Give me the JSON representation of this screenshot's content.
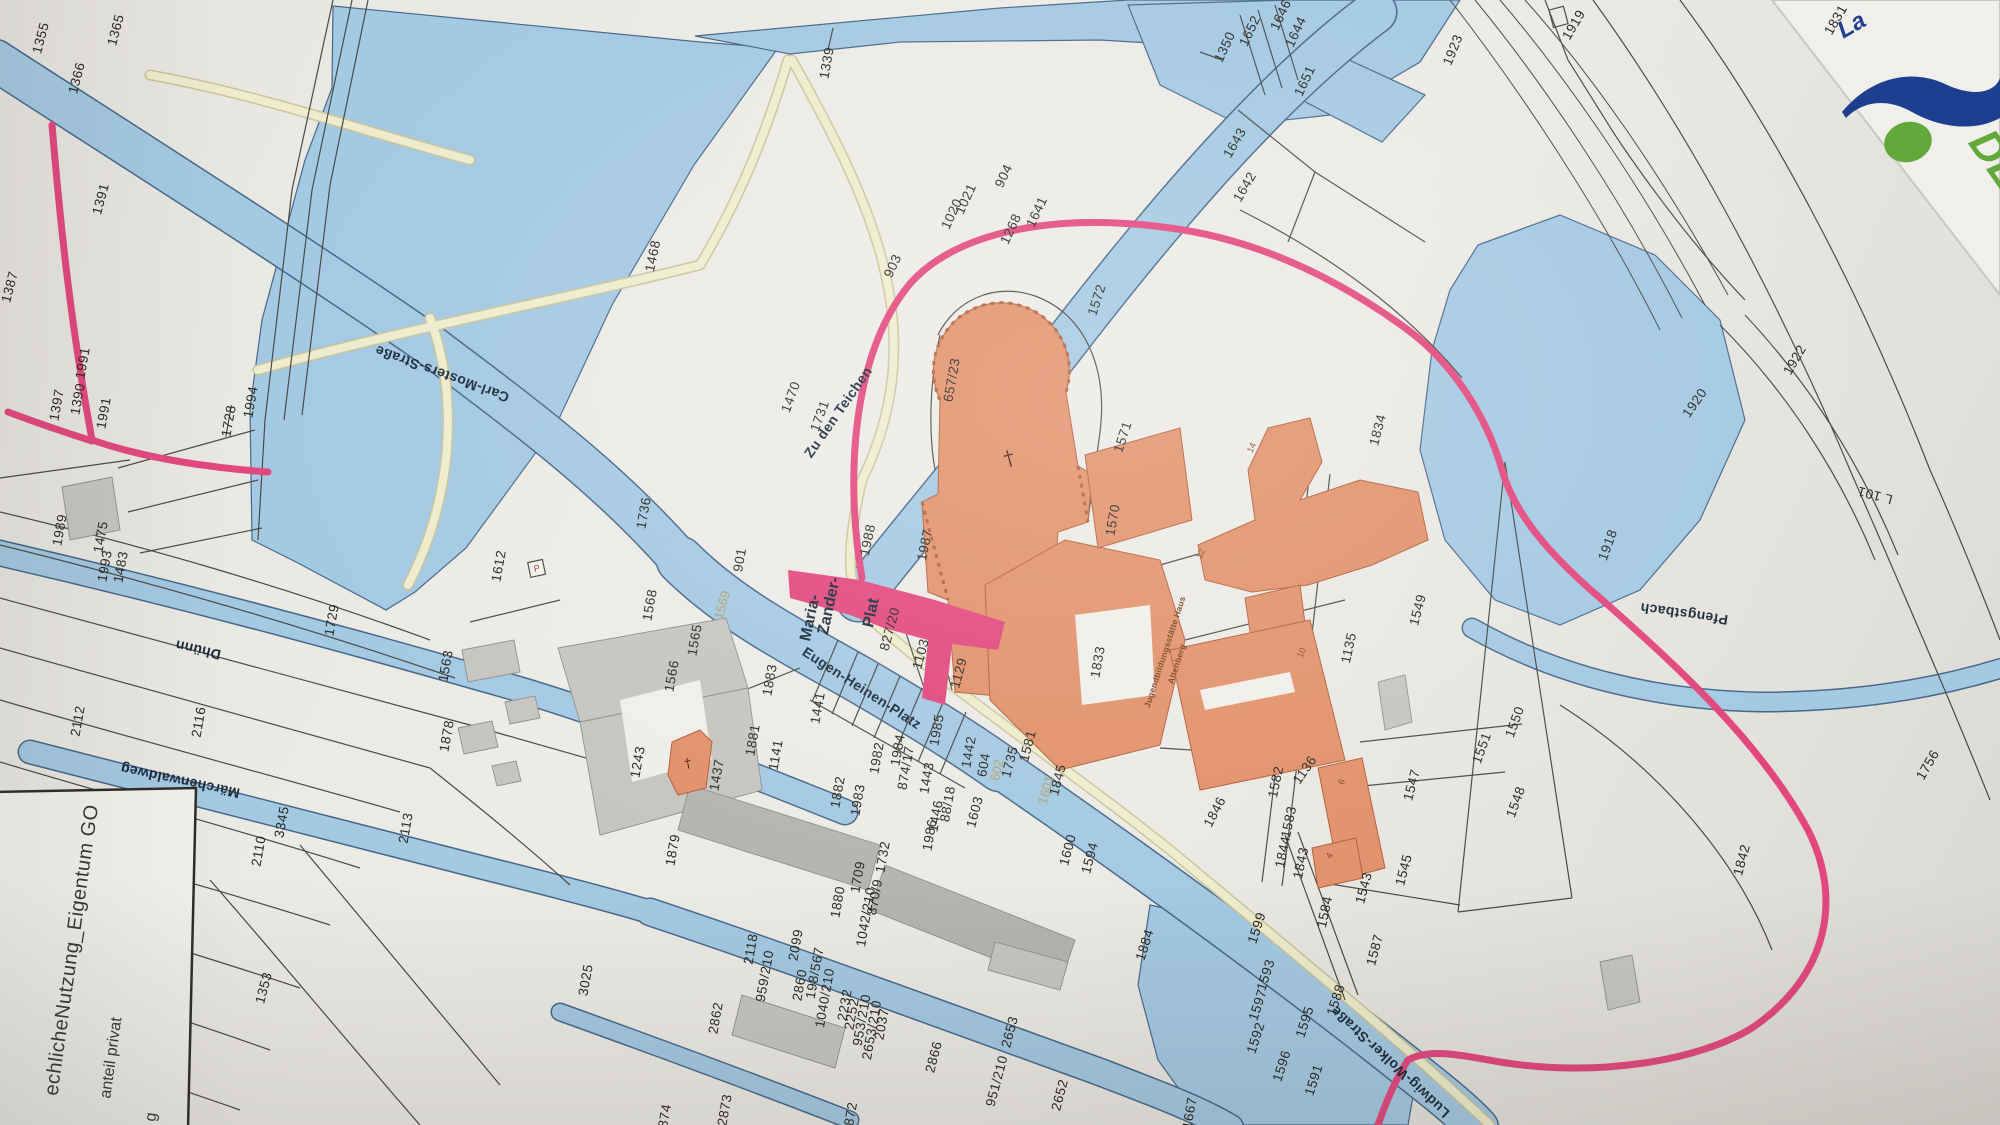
{
  "map": {
    "kind": "cadastral parcel map photo (Altenberg / Odenthal area)",
    "colors": {
      "paper": "#e9e7e1",
      "water": "#a4c9e3",
      "water_edge": "#47688a",
      "building_orange": "#e2916a",
      "building_gray": "#c6c5c1",
      "path_cream": "#eeeccd",
      "route_pink": "#e2487e",
      "boundary_line": "#4c4a45",
      "label_text": "#2b2923",
      "logo_navy": "#1e3f8f",
      "logo_green": "#61a93a"
    },
    "legend": {
      "line1": "echlicheNutzung_Eigentum GO",
      "line2": "anteil privat",
      "line3": "g"
    },
    "logo": {
      "italic_text": "La",
      "green_text": "DE"
    },
    "symbols": {
      "church_cross": "†",
      "parking": "P"
    },
    "labels": [
      {
        "t": "1355",
        "x": 41,
        "y": 38,
        "r": -75,
        "cls": "p"
      },
      {
        "t": "1366",
        "x": 77,
        "y": 78,
        "r": -75,
        "cls": "p"
      },
      {
        "t": "1365",
        "x": 116,
        "y": 30,
        "r": -75,
        "cls": "p"
      },
      {
        "t": "1391",
        "x": 101,
        "y": 199,
        "r": -75,
        "cls": "p"
      },
      {
        "t": "1387",
        "x": 10,
        "y": 287,
        "r": -75,
        "cls": "p"
      },
      {
        "t": "1397",
        "x": 57,
        "y": 405,
        "r": -80,
        "cls": "p"
      },
      {
        "t": "1390",
        "x": 78,
        "y": 399,
        "r": -80,
        "cls": "p"
      },
      {
        "t": "1991",
        "x": 83,
        "y": 363,
        "r": -80,
        "cls": "p"
      },
      {
        "t": "1991",
        "x": 104,
        "y": 413,
        "r": -80,
        "cls": "p"
      },
      {
        "t": "1994",
        "x": 251,
        "y": 402,
        "r": -80,
        "cls": "p"
      },
      {
        "t": "1728",
        "x": 229,
        "y": 421,
        "r": -80,
        "cls": "p strike"
      },
      {
        "t": "1989",
        "x": 60,
        "y": 530,
        "r": -80,
        "cls": "p"
      },
      {
        "t": "1475",
        "x": 101,
        "y": 537,
        "r": -80,
        "cls": "p"
      },
      {
        "t": "1993",
        "x": 105,
        "y": 566,
        "r": -80,
        "cls": "p"
      },
      {
        "t": "1483",
        "x": 121,
        "y": 567,
        "r": -80,
        "cls": "p"
      },
      {
        "t": "1729",
        "x": 332,
        "y": 620,
        "r": -80,
        "cls": "p"
      },
      {
        "t": "2112",
        "x": 78,
        "y": 721,
        "r": -80,
        "cls": "p"
      },
      {
        "t": "2116",
        "x": 199,
        "y": 722,
        "r": -80,
        "cls": "p"
      },
      {
        "t": "3345",
        "x": 282,
        "y": 822,
        "r": -80,
        "cls": "p"
      },
      {
        "t": "2110",
        "x": 259,
        "y": 851,
        "r": -80,
        "cls": "p"
      },
      {
        "t": "2113",
        "x": 406,
        "y": 828,
        "r": -80,
        "cls": "p"
      },
      {
        "t": "1353",
        "x": 264,
        "y": 988,
        "r": -75,
        "cls": "p"
      },
      {
        "t": "1468",
        "x": 653,
        "y": 256,
        "r": -78,
        "cls": "p"
      },
      {
        "t": "1339",
        "x": 827,
        "y": 63,
        "r": -80,
        "cls": "p"
      },
      {
        "t": "1470",
        "x": 791,
        "y": 397,
        "r": -70,
        "cls": "p"
      },
      {
        "t": "1731",
        "x": 820,
        "y": 416,
        "r": -70,
        "cls": "p"
      },
      {
        "t": "1736",
        "x": 644,
        "y": 513,
        "r": -80,
        "cls": "p"
      },
      {
        "t": "1612",
        "x": 499,
        "y": 566,
        "r": -80,
        "cls": "p"
      },
      {
        "t": "1563",
        "x": 446,
        "y": 666,
        "r": -80,
        "cls": "p"
      },
      {
        "t": "1878",
        "x": 447,
        "y": 736,
        "r": -80,
        "cls": "p"
      },
      {
        "t": "1568",
        "x": 650,
        "y": 605,
        "r": -80,
        "cls": "p"
      },
      {
        "t": "1565",
        "x": 695,
        "y": 640,
        "r": -80,
        "cls": "p"
      },
      {
        "t": "1566",
        "x": 672,
        "y": 676,
        "r": -80,
        "cls": "p"
      },
      {
        "t": "1243",
        "x": 638,
        "y": 762,
        "r": -80,
        "cls": "p"
      },
      {
        "t": "1437",
        "x": 717,
        "y": 775,
        "r": -80,
        "cls": "p"
      },
      {
        "t": "1881",
        "x": 753,
        "y": 740,
        "r": -80,
        "cls": "p"
      },
      {
        "t": "1141",
        "x": 776,
        "y": 755,
        "r": -80,
        "cls": "p"
      },
      {
        "t": "1883",
        "x": 770,
        "y": 680,
        "r": -80,
        "cls": "p"
      },
      {
        "t": "1441",
        "x": 818,
        "y": 708,
        "r": -80,
        "cls": "p"
      },
      {
        "t": "1879",
        "x": 673,
        "y": 850,
        "r": -80,
        "cls": "p"
      },
      {
        "t": "1882",
        "x": 838,
        "y": 792,
        "r": -80,
        "cls": "p"
      },
      {
        "t": "1983",
        "x": 858,
        "y": 800,
        "r": -80,
        "cls": "p"
      },
      {
        "t": "1982",
        "x": 877,
        "y": 758,
        "r": -80,
        "cls": "p"
      },
      {
        "t": "1984",
        "x": 898,
        "y": 750,
        "r": -80,
        "cls": "p"
      },
      {
        "t": "874/17",
        "x": 906,
        "y": 768,
        "r": -80,
        "cls": "p"
      },
      {
        "t": "1443",
        "x": 927,
        "y": 778,
        "r": -80,
        "cls": "p"
      },
      {
        "t": "1985",
        "x": 937,
        "y": 730,
        "r": -80,
        "cls": "p"
      },
      {
        "t": "1442",
        "x": 969,
        "y": 752,
        "r": -80,
        "cls": "p"
      },
      {
        "t": "604",
        "x": 984,
        "y": 765,
        "r": -80,
        "cls": "p"
      },
      {
        "t": "602",
        "x": 997,
        "y": 770,
        "r": -78,
        "cls": "tan"
      },
      {
        "t": "1601",
        "x": 1046,
        "y": 790,
        "r": -75,
        "cls": "tan"
      },
      {
        "t": "1569",
        "x": 722,
        "y": 605,
        "r": -75,
        "cls": "tan"
      },
      {
        "t": "901",
        "x": 740,
        "y": 560,
        "r": -80,
        "cls": "p"
      },
      {
        "t": "1988",
        "x": 868,
        "y": 540,
        "r": -78,
        "cls": "p"
      },
      {
        "t": "1987",
        "x": 925,
        "y": 545,
        "r": -78,
        "cls": "p"
      },
      {
        "t": "657/23",
        "x": 952,
        "y": 380,
        "r": -80,
        "cls": "p"
      },
      {
        "t": "1572",
        "x": 1097,
        "y": 300,
        "r": -72,
        "cls": "p"
      },
      {
        "t": "1571",
        "x": 1123,
        "y": 437,
        "r": -72,
        "cls": "p"
      },
      {
        "t": "1570",
        "x": 1113,
        "y": 520,
        "r": -80,
        "cls": "p"
      },
      {
        "t": "1833",
        "x": 1098,
        "y": 662,
        "r": -80,
        "cls": "p"
      },
      {
        "t": "1834",
        "x": 1378,
        "y": 430,
        "r": -75,
        "cls": "p"
      },
      {
        "t": "1103",
        "x": 921,
        "y": 654,
        "r": -75,
        "cls": "p"
      },
      {
        "t": "1129",
        "x": 959,
        "y": 673,
        "r": -75,
        "cls": "p"
      },
      {
        "t": "827/20",
        "x": 890,
        "y": 629,
        "r": -75,
        "cls": "p"
      },
      {
        "t": "1135",
        "x": 1349,
        "y": 648,
        "r": -78,
        "cls": "p"
      },
      {
        "t": "1549",
        "x": 1418,
        "y": 610,
        "r": -75,
        "cls": "p"
      },
      {
        "t": "1550",
        "x": 1515,
        "y": 722,
        "r": -70,
        "cls": "p"
      },
      {
        "t": "1551",
        "x": 1482,
        "y": 748,
        "r": -70,
        "cls": "p"
      },
      {
        "t": "1547",
        "x": 1412,
        "y": 785,
        "r": -75,
        "cls": "p"
      },
      {
        "t": "1548",
        "x": 1516,
        "y": 802,
        "r": -70,
        "cls": "p"
      },
      {
        "t": "1545",
        "x": 1404,
        "y": 870,
        "r": -75,
        "cls": "p"
      },
      {
        "t": "1543",
        "x": 1364,
        "y": 888,
        "r": -75,
        "cls": "p"
      },
      {
        "t": "1582",
        "x": 1276,
        "y": 782,
        "r": -78,
        "cls": "p"
      },
      {
        "t": "1583",
        "x": 1289,
        "y": 822,
        "r": -78,
        "cls": "p"
      },
      {
        "t": "1844",
        "x": 1283,
        "y": 852,
        "r": -78,
        "cls": "p"
      },
      {
        "t": "1843",
        "x": 1301,
        "y": 863,
        "r": -78,
        "cls": "p"
      },
      {
        "t": "1584",
        "x": 1325,
        "y": 912,
        "r": -78,
        "cls": "p"
      },
      {
        "t": "1587",
        "x": 1375,
        "y": 950,
        "r": -75,
        "cls": "p"
      },
      {
        "t": "1581",
        "x": 1028,
        "y": 746,
        "r": -75,
        "cls": "p"
      },
      {
        "t": "1735",
        "x": 1010,
        "y": 762,
        "r": -75,
        "cls": "p"
      },
      {
        "t": "1845",
        "x": 1058,
        "y": 780,
        "r": -75,
        "cls": "p"
      },
      {
        "t": "1846",
        "x": 1215,
        "y": 812,
        "r": -62,
        "cls": "p"
      },
      {
        "t": "1600",
        "x": 1068,
        "y": 850,
        "r": -75,
        "cls": "p"
      },
      {
        "t": "1594",
        "x": 1090,
        "y": 858,
        "r": -75,
        "cls": "p"
      },
      {
        "t": "1603",
        "x": 975,
        "y": 812,
        "r": -75,
        "cls": "p"
      },
      {
        "t": "1884",
        "x": 1145,
        "y": 945,
        "r": -72,
        "cls": "p"
      },
      {
        "t": "1599",
        "x": 1257,
        "y": 928,
        "r": -72,
        "cls": "p"
      },
      {
        "t": "1593",
        "x": 1266,
        "y": 975,
        "r": -72,
        "cls": "p"
      },
      {
        "t": "1597",
        "x": 1258,
        "y": 1005,
        "r": -72,
        "cls": "p"
      },
      {
        "t": "1592",
        "x": 1256,
        "y": 1038,
        "r": -72,
        "cls": "p"
      },
      {
        "t": "1596",
        "x": 1282,
        "y": 1066,
        "r": -72,
        "cls": "p"
      },
      {
        "t": "1591",
        "x": 1314,
        "y": 1080,
        "r": -72,
        "cls": "p"
      },
      {
        "t": "1595",
        "x": 1305,
        "y": 1022,
        "r": -72,
        "cls": "p"
      },
      {
        "t": "1588",
        "x": 1336,
        "y": 1000,
        "r": -72,
        "cls": "p"
      },
      {
        "t": "1842",
        "x": 1742,
        "y": 860,
        "r": -75,
        "cls": "p"
      },
      {
        "t": "1756",
        "x": 1928,
        "y": 765,
        "r": -60,
        "cls": "p"
      },
      {
        "t": "1920",
        "x": 1695,
        "y": 403,
        "r": -55,
        "cls": "p"
      },
      {
        "t": "1922",
        "x": 1795,
        "y": 360,
        "r": -60,
        "cls": "p"
      },
      {
        "t": "1918",
        "x": 1608,
        "y": 545,
        "r": -70,
        "cls": "p"
      },
      {
        "t": "1923",
        "x": 1453,
        "y": 50,
        "r": -68,
        "cls": "p"
      },
      {
        "t": "1919",
        "x": 1574,
        "y": 25,
        "r": -60,
        "cls": "p"
      },
      {
        "t": "1831",
        "x": 1836,
        "y": 20,
        "r": -60,
        "cls": "p"
      },
      {
        "t": "1350",
        "x": 1225,
        "y": 47,
        "r": -65,
        "cls": "p"
      },
      {
        "t": "1652",
        "x": 1250,
        "y": 31,
        "r": -65,
        "cls": "p"
      },
      {
        "t": "1646",
        "x": 1281,
        "y": 15,
        "r": -65,
        "cls": "p"
      },
      {
        "t": "1644",
        "x": 1296,
        "y": 32,
        "r": -65,
        "cls": "p"
      },
      {
        "t": "1651",
        "x": 1305,
        "y": 81,
        "r": -65,
        "cls": "p"
      },
      {
        "t": "1643",
        "x": 1235,
        "y": 143,
        "r": -60,
        "cls": "p"
      },
      {
        "t": "1642",
        "x": 1245,
        "y": 187,
        "r": -60,
        "cls": "p"
      },
      {
        "t": "904",
        "x": 1004,
        "y": 176,
        "r": -65,
        "cls": "p"
      },
      {
        "t": "1020",
        "x": 952,
        "y": 214,
        "r": -65,
        "cls": "p"
      },
      {
        "t": "1021",
        "x": 966,
        "y": 199,
        "r": -65,
        "cls": "p"
      },
      {
        "t": "1268",
        "x": 1011,
        "y": 229,
        "r": -65,
        "cls": "p"
      },
      {
        "t": "1641",
        "x": 1037,
        "y": 212,
        "r": -65,
        "cls": "p"
      },
      {
        "t": "903",
        "x": 893,
        "y": 266,
        "r": -65,
        "cls": "p"
      },
      {
        "t": "1880",
        "x": 838,
        "y": 902,
        "r": -80,
        "cls": "p"
      },
      {
        "t": "1709",
        "x": 858,
        "y": 877,
        "r": -80,
        "cls": "p"
      },
      {
        "t": "870/9",
        "x": 875,
        "y": 897,
        "r": -80,
        "cls": "p"
      },
      {
        "t": "1042/210",
        "x": 866,
        "y": 917,
        "r": -80,
        "cls": "p"
      },
      {
        "t": "1732",
        "x": 883,
        "y": 857,
        "r": -80,
        "cls": "p"
      },
      {
        "t": "1986",
        "x": 930,
        "y": 835,
        "r": -80,
        "cls": "p"
      },
      {
        "t": "1446",
        "x": 936,
        "y": 816,
        "r": -80,
        "cls": "p"
      },
      {
        "t": "88/18",
        "x": 948,
        "y": 804,
        "r": -80,
        "cls": "p"
      },
      {
        "t": "2118",
        "x": 751,
        "y": 949,
        "r": -80,
        "cls": "p"
      },
      {
        "t": "959/210",
        "x": 765,
        "y": 976,
        "r": -80,
        "cls": "p"
      },
      {
        "t": "2099",
        "x": 796,
        "y": 945,
        "r": -80,
        "cls": "p"
      },
      {
        "t": "2860",
        "x": 800,
        "y": 985,
        "r": -80,
        "cls": "p"
      },
      {
        "t": "198/567",
        "x": 815,
        "y": 973,
        "r": -80,
        "cls": "p"
      },
      {
        "t": "1040/210",
        "x": 825,
        "y": 998,
        "r": -80,
        "cls": "p"
      },
      {
        "t": "2232",
        "x": 845,
        "y": 1005,
        "r": -80,
        "cls": "p"
      },
      {
        "t": "2252",
        "x": 852,
        "y": 1014,
        "r": -80,
        "cls": "p"
      },
      {
        "t": "953/210",
        "x": 862,
        "y": 1020,
        "r": -80,
        "cls": "p"
      },
      {
        "t": "2653/210",
        "x": 872,
        "y": 1030,
        "r": -80,
        "cls": "p"
      },
      {
        "t": "2037",
        "x": 882,
        "y": 1024,
        "r": -80,
        "cls": "p"
      },
      {
        "t": "2862",
        "x": 716,
        "y": 1018,
        "r": -80,
        "cls": "p"
      },
      {
        "t": "2873",
        "x": 725,
        "y": 1110,
        "r": -80,
        "cls": "p"
      },
      {
        "t": "874",
        "x": 665,
        "y": 1116,
        "r": -80,
        "cls": "p"
      },
      {
        "t": "872",
        "x": 851,
        "y": 1114,
        "r": -80,
        "cls": "p"
      },
      {
        "t": "3025",
        "x": 586,
        "y": 980,
        "r": -80,
        "cls": "p"
      },
      {
        "t": "2866",
        "x": 934,
        "y": 1057,
        "r": -75,
        "cls": "p"
      },
      {
        "t": "951/210",
        "x": 997,
        "y": 1081,
        "r": -75,
        "cls": "p"
      },
      {
        "t": "2653",
        "x": 1010,
        "y": 1032,
        "r": -75,
        "cls": "p"
      },
      {
        "t": "2652",
        "x": 1060,
        "y": 1095,
        "r": -75,
        "cls": "p"
      },
      {
        "t": "1667",
        "x": 1190,
        "y": 1113,
        "r": -80,
        "cls": "p"
      },
      {
        "t": "1136",
        "x": 1305,
        "y": 770,
        "r": -55,
        "cls": "p"
      },
      {
        "t": "Carl-Mosters-Straße",
        "x": 442,
        "y": 374,
        "r": 200,
        "cls": "s"
      },
      {
        "t": "Eugen-Heinen-Platz",
        "x": 862,
        "y": 688,
        "r": 33,
        "cls": "s"
      },
      {
        "t": "Zu den Teichen",
        "x": 838,
        "y": 412,
        "r": -55,
        "cls": "s"
      },
      {
        "t": "Maria-",
        "x": 811,
        "y": 618,
        "r": -78,
        "cls": "big"
      },
      {
        "t": "Zander-",
        "x": 830,
        "y": 606,
        "r": -78,
        "cls": "big"
      },
      {
        "t": "Plat",
        "x": 872,
        "y": 613,
        "r": -78,
        "cls": "big"
      },
      {
        "t": "Märchenwaldweg",
        "x": 180,
        "y": 781,
        "r": 192,
        "cls": "s"
      },
      {
        "t": "Dhünn",
        "x": 198,
        "y": 650,
        "r": 193,
        "cls": "s"
      },
      {
        "t": "Ludwig-Wolker-Straße",
        "x": 1390,
        "y": 1062,
        "r": 223,
        "cls": "s"
      },
      {
        "t": "Pfengstbach",
        "x": 1684,
        "y": 614,
        "r": 188,
        "cls": "s"
      },
      {
        "t": "L 101",
        "x": 1875,
        "y": 495,
        "r": 195,
        "cls": "p"
      },
      {
        "t": "Jugendbildungsstätte Haus",
        "x": 1165,
        "y": 652,
        "r": -72,
        "cls": "tiny"
      },
      {
        "t": "Altenberg",
        "x": 1177,
        "y": 664,
        "r": -72,
        "cls": "tiny"
      },
      {
        "t": "14",
        "x": 1252,
        "y": 448,
        "r": -65,
        "cls": "hn"
      },
      {
        "t": "12",
        "x": 1201,
        "y": 554,
        "r": -65,
        "cls": "hn"
      },
      {
        "t": "10",
        "x": 1302,
        "y": 653,
        "r": -65,
        "cls": "hn"
      },
      {
        "t": "6",
        "x": 1342,
        "y": 782,
        "r": -65,
        "cls": "hn"
      },
      {
        "t": "4",
        "x": 1330,
        "y": 856,
        "r": -65,
        "cls": "hn"
      },
      {
        "t": "†",
        "x": 1009,
        "y": 458,
        "r": -15,
        "cls": "cross"
      },
      {
        "t": "†",
        "x": 688,
        "y": 764,
        "r": -10,
        "cls": "cross",
        "fs": 13
      },
      {
        "t": "P",
        "x": 537,
        "y": 569,
        "r": -12,
        "cls": "hn"
      },
      {
        "t": "echlicheNutzung_Eigentum GO",
        "x": 72,
        "y": 950,
        "r": -82,
        "cls": "leg1"
      },
      {
        "t": "anteil privat",
        "x": 112,
        "y": 1058,
        "r": -82,
        "cls": "leg2"
      },
      {
        "t": "g",
        "x": 152,
        "y": 1117,
        "r": -82,
        "cls": "leg2"
      },
      {
        "t": "La",
        "x": 1852,
        "y": 26,
        "r": -30,
        "cls": "logo-la"
      },
      {
        "t": "DE",
        "x": 1996,
        "y": 160,
        "r": 55,
        "cls": "logo-de"
      }
    ]
  }
}
